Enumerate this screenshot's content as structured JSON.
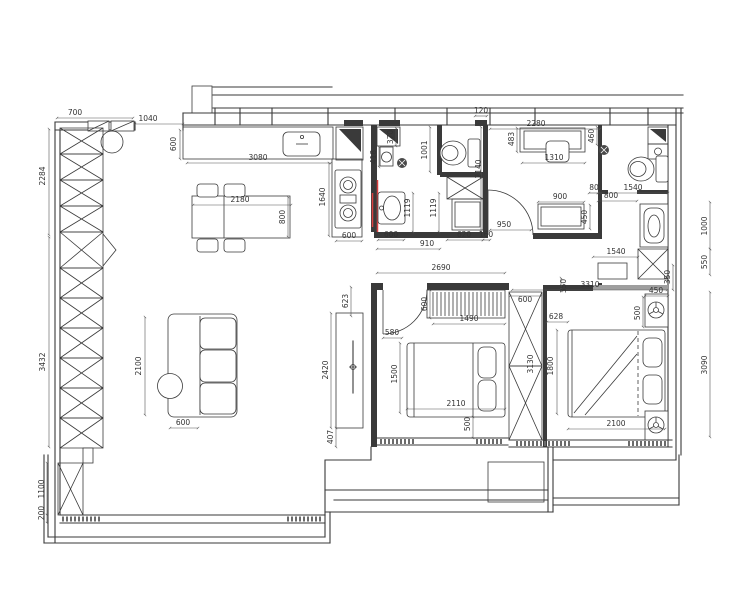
{
  "colors": {
    "ink": "#3a3a3a",
    "dim_line": "#555555",
    "dim_text": "#333333",
    "accent_red": "#d94040",
    "threshold_gray": "#9e9e9e",
    "hatch_gray": "#6b6b6b",
    "paper": "#ffffff"
  },
  "icons": {
    "gas_stove": "two-burner-circles",
    "kitchen_sink": "rounded-basin",
    "toilet": "tank-and-bowl",
    "floor_drain": "filled-circle-cross",
    "bedside_lamp": "circle-with-spokes",
    "wardrobe": "rect-with-x-cross",
    "corner_sink": "black-triangle-square"
  },
  "dimensions": [
    {
      "label": "700",
      "x": 75,
      "y": 115,
      "rot": 0
    },
    {
      "label": "1040",
      "x": 148,
      "y": 121,
      "rot": 0
    },
    {
      "label": "600",
      "x": 176,
      "y": 144,
      "rot": -90
    },
    {
      "label": "3080",
      "x": 258,
      "y": 160,
      "rot": 0
    },
    {
      "label": "2180",
      "x": 240,
      "y": 202,
      "rot": 0
    },
    {
      "label": "800",
      "x": 285,
      "y": 217,
      "rot": -90
    },
    {
      "label": "2284",
      "x": 45,
      "y": 176,
      "rot": -90
    },
    {
      "label": "3432",
      "x": 45,
      "y": 362,
      "rot": -90
    },
    {
      "label": "1100",
      "x": 44,
      "y": 489,
      "rot": -90
    },
    {
      "label": "200",
      "x": 44,
      "y": 513,
      "rot": -90
    },
    {
      "label": "1640",
      "x": 325,
      "y": 197,
      "rot": -90
    },
    {
      "label": "600",
      "x": 349,
      "y": 238,
      "rot": 0
    },
    {
      "label": "370",
      "x": 393,
      "y": 137,
      "rot": -90
    },
    {
      "label": "418",
      "x": 376,
      "y": 157,
      "rot": -90
    },
    {
      "label": "1001",
      "x": 427,
      "y": 150,
      "rot": -90
    },
    {
      "label": "1119",
      "x": 410,
      "y": 208,
      "rot": -90
    },
    {
      "label": "1119",
      "x": 436,
      "y": 208,
      "rot": -90
    },
    {
      "label": "600",
      "x": 391,
      "y": 237,
      "rot": 0
    },
    {
      "label": "910",
      "x": 427,
      "y": 246,
      "rot": 0
    },
    {
      "label": "620",
      "x": 464,
      "y": 237,
      "rot": 0
    },
    {
      "label": "160",
      "x": 486,
      "y": 237,
      "rot": 0
    },
    {
      "label": "2140",
      "x": 481,
      "y": 169,
      "rot": -90
    },
    {
      "label": "120",
      "x": 481,
      "y": 113,
      "rot": 0
    },
    {
      "label": "2690",
      "x": 441,
      "y": 270,
      "rot": 0
    },
    {
      "label": "950",
      "x": 504,
      "y": 227,
      "rot": 0
    },
    {
      "label": "2280",
      "x": 536,
      "y": 126,
      "rot": 0
    },
    {
      "label": "483",
      "x": 514,
      "y": 139,
      "rot": -90
    },
    {
      "label": "1310",
      "x": 554,
      "y": 160,
      "rot": 0
    },
    {
      "label": "900",
      "x": 560,
      "y": 199,
      "rot": 0
    },
    {
      "label": "450",
      "x": 587,
      "y": 217,
      "rot": -90
    },
    {
      "label": "460",
      "x": 594,
      "y": 136,
      "rot": -90
    },
    {
      "label": "80",
      "x": 594,
      "y": 190,
      "rot": 0
    },
    {
      "label": "1540",
      "x": 633,
      "y": 190,
      "rot": 0
    },
    {
      "label": "800",
      "x": 611,
      "y": 198,
      "rot": 0
    },
    {
      "label": "1540",
      "x": 616,
      "y": 254,
      "rot": 0
    },
    {
      "label": "350",
      "x": 670,
      "y": 277,
      "rot": -90
    },
    {
      "label": "3310",
      "x": 590,
      "y": 287,
      "rot": 0
    },
    {
      "label": "1000",
      "x": 707,
      "y": 226,
      "rot": -90
    },
    {
      "label": "550",
      "x": 707,
      "y": 262,
      "rot": -90
    },
    {
      "label": "3090",
      "x": 707,
      "y": 365,
      "rot": -90
    },
    {
      "label": "623",
      "x": 348,
      "y": 301,
      "rot": -90
    },
    {
      "label": "2420",
      "x": 328,
      "y": 370,
      "rot": -90
    },
    {
      "label": "407",
      "x": 333,
      "y": 437,
      "rot": -90
    },
    {
      "label": "580",
      "x": 392,
      "y": 335,
      "rot": 0
    },
    {
      "label": "600",
      "x": 427,
      "y": 304,
      "rot": -90
    },
    {
      "label": "1490",
      "x": 469,
      "y": 321,
      "rot": 0
    },
    {
      "label": "1500",
      "x": 397,
      "y": 374,
      "rot": -90
    },
    {
      "label": "2110",
      "x": 456,
      "y": 406,
      "rot": 0
    },
    {
      "label": "500",
      "x": 470,
      "y": 424,
      "rot": -90
    },
    {
      "label": "600",
      "x": 525,
      "y": 302,
      "rot": 0
    },
    {
      "label": "3130",
      "x": 533,
      "y": 364,
      "rot": -90
    },
    {
      "label": "628",
      "x": 556,
      "y": 319,
      "rot": 0
    },
    {
      "label": "450",
      "x": 656,
      "y": 293,
      "rot": 0
    },
    {
      "label": "500",
      "x": 640,
      "y": 313,
      "rot": -90
    },
    {
      "label": "1800",
      "x": 553,
      "y": 366,
      "rot": -90
    },
    {
      "label": "2100",
      "x": 616,
      "y": 426,
      "rot": 0
    },
    {
      "label": "2100",
      "x": 141,
      "y": 366,
      "rot": -90
    },
    {
      "label": "600",
      "x": 183,
      "y": 425,
      "rot": 0
    },
    {
      "label": "350",
      "x": 566,
      "y": 286,
      "rot": -90
    }
  ]
}
